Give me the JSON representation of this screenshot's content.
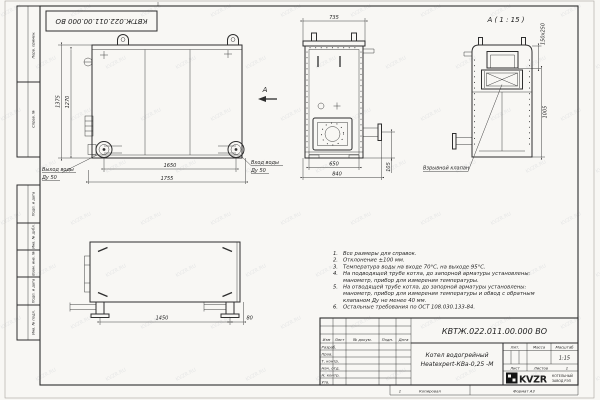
{
  "watermark": "KVZR.RU",
  "frame": {
    "margin_labels": [
      "Перв. примен.",
      "Справ. №",
      "Подп. и дата",
      "Инв. № дубл.",
      "Взам. инв. №",
      "Подп. и дата",
      "Инв. № подл."
    ]
  },
  "views": {
    "front": {
      "dim_height_outer": "1375",
      "dim_height_inner": "1270",
      "dim_width_inner": "1650",
      "dim_width_outer": "1755",
      "outlet_label": "Выход воды",
      "outlet_dn": "Ду 50",
      "inlet_label": "Вход воды",
      "inlet_dn": "Ду 50",
      "view_letter": "А"
    },
    "side": {
      "dim_width_top": "735",
      "dim_width_base": "650",
      "dim_width_full": "840",
      "dim_pipe": "105"
    },
    "detail": {
      "title": "А ( 1 : 15 )",
      "dim_vent": "150х250",
      "dim_height": "1005",
      "valve_label": "Взрывной клапан"
    },
    "plan": {
      "dim_supports": "1450",
      "dim_offset": "80"
    }
  },
  "notes": {
    "lines": [
      {
        "n": "1.",
        "t": "Все размеры для справок."
      },
      {
        "n": "2.",
        "t": "Отклонение ±100 мм."
      },
      {
        "n": "3.",
        "t": "Температура воды на входе 70°С, на выходе 95°С."
      },
      {
        "n": "4.",
        "t": "На подводящей трубе котла, до запорной арматуры установлены:"
      },
      {
        "n": "",
        "t": "манометр, прибор для измерения температуры."
      },
      {
        "n": "5.",
        "t": "На отводящей трубе котла, до запорной арматуры установлены:"
      },
      {
        "n": "",
        "t": "манометр, прибор для измерения температуры и обвод с обратным"
      },
      {
        "n": "",
        "t": "клапаном Ду не менее 40 мм."
      },
      {
        "n": "6.",
        "t": "Остальные требования по ОСТ 108.030.133-84."
      }
    ]
  },
  "title_block": {
    "doc_number": "КВТЖ.022.011.00.000 ВО",
    "product_name_1": "Котел водогрейный",
    "product_name_2": "Heatexpert-КВа-0,25 -М",
    "columns": {
      "izm": "Изм",
      "list": "Лист",
      "doc": "№ докум.",
      "podp": "Подп.",
      "data": "Дата"
    },
    "rows": [
      "Разраб.",
      "Пров.",
      "Т. контр.",
      "Нач. отд.",
      "Н. контр.",
      "Утв."
    ],
    "lit_label": "Лит.",
    "mass_label": "Масса",
    "scale_label": "Масштаб",
    "scale_value": "1:15",
    "sheet_label": "Лист",
    "sheets_label": "Листов",
    "sheets_value": "1",
    "logo_text": "KVZR",
    "org_line_1": "КОТЕЛЬНЫЙ",
    "org_line_2": "ЗАВОД РЭП",
    "zone_mark": "1",
    "copied_label": "Копировал",
    "format_label": "Формат А3"
  }
}
